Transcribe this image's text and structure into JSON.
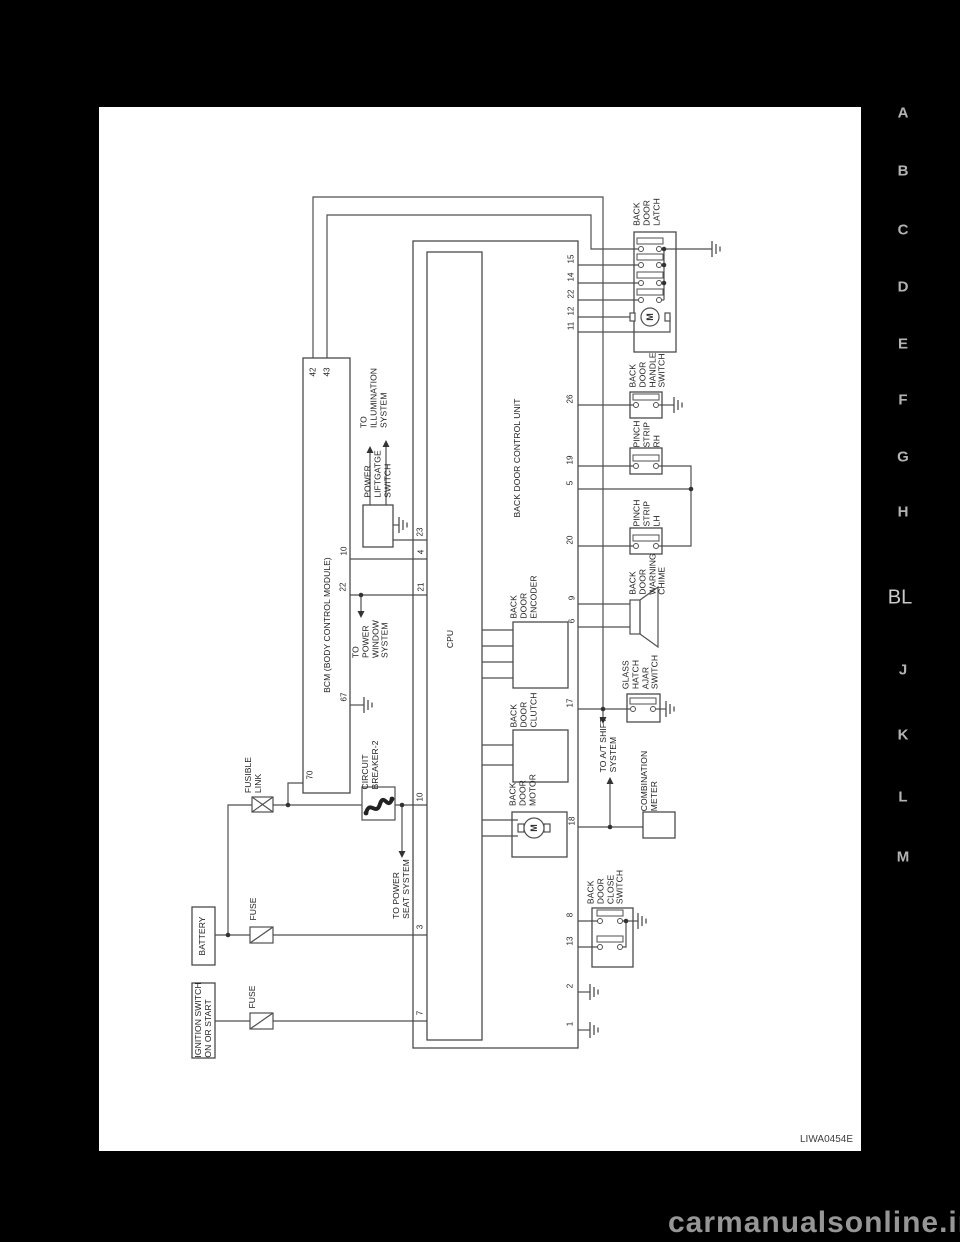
{
  "page": {
    "watermark": "carmanualsonline.info",
    "figure_code": "LIWA0454E"
  },
  "tabs": {
    "items": [
      "A",
      "B",
      "C",
      "D",
      "E",
      "F",
      "G",
      "H",
      "BL",
      "J",
      "K",
      "L",
      "M"
    ],
    "active": "BL"
  },
  "labels": {
    "bcm": "BCM (BODY CONTROL MODULE)",
    "control_unit": "BACK DOOR CONTROL UNIT",
    "cpu": "CPU",
    "latch": "BACK\nDOOR\nLATCH",
    "handle": "BACK\nDOOR\nHANDLE\nSWITCH",
    "pinch_rh": "PINCH\nSTRIP\nRH",
    "pinch_lh": "PINCH\nSTRIP\nLH",
    "chime": "BACK\nDOOR\nWARNING\nCHIME",
    "glass": "GLASS\nHATCH\nAJAR\nSWITCH",
    "encoder": "BACK\nDOOR\nENCODER",
    "clutch": "BACK\nDOOR\nCLUTCH",
    "motor": "BACK\nDOOR\nMOTOR",
    "combo": "COMBINATION\nMETER",
    "close": "BACK\nDOOR\nCLOSE\nSWITCH",
    "liftgate": "POWER\nLIFTGATGE\nSWITCH",
    "illum": "TO\nILLUMINATION\nSYSTEM",
    "window": "TO\nPOWER\nWINDOW\nSYSTEM",
    "seat": "TO POWER\nSEAT SYSTEM",
    "atshift": "TO A/T SHIFT\nSYSTEM",
    "fusible": "FUSIBLE\nLINK",
    "fuse1": "FUSE",
    "fuse2": "FUSE",
    "breaker": "CIRCUIT\nBREAKER-2",
    "battery": "BATTERY",
    "ignition": "IGNITION SWITCH\nON OR START",
    "motor_symbol": "M"
  },
  "pins": {
    "bcm": [
      "42",
      "43",
      "10",
      "22",
      "67",
      "70"
    ],
    "unit_left": [
      "23",
      "4",
      "21",
      "10",
      "3",
      "7"
    ],
    "unit_right": [
      "15",
      "14",
      "22",
      "12",
      "11",
      "26",
      "19",
      "5",
      "20",
      "9",
      "6",
      "17",
      "18",
      "8",
      "13",
      "2",
      "1"
    ]
  }
}
